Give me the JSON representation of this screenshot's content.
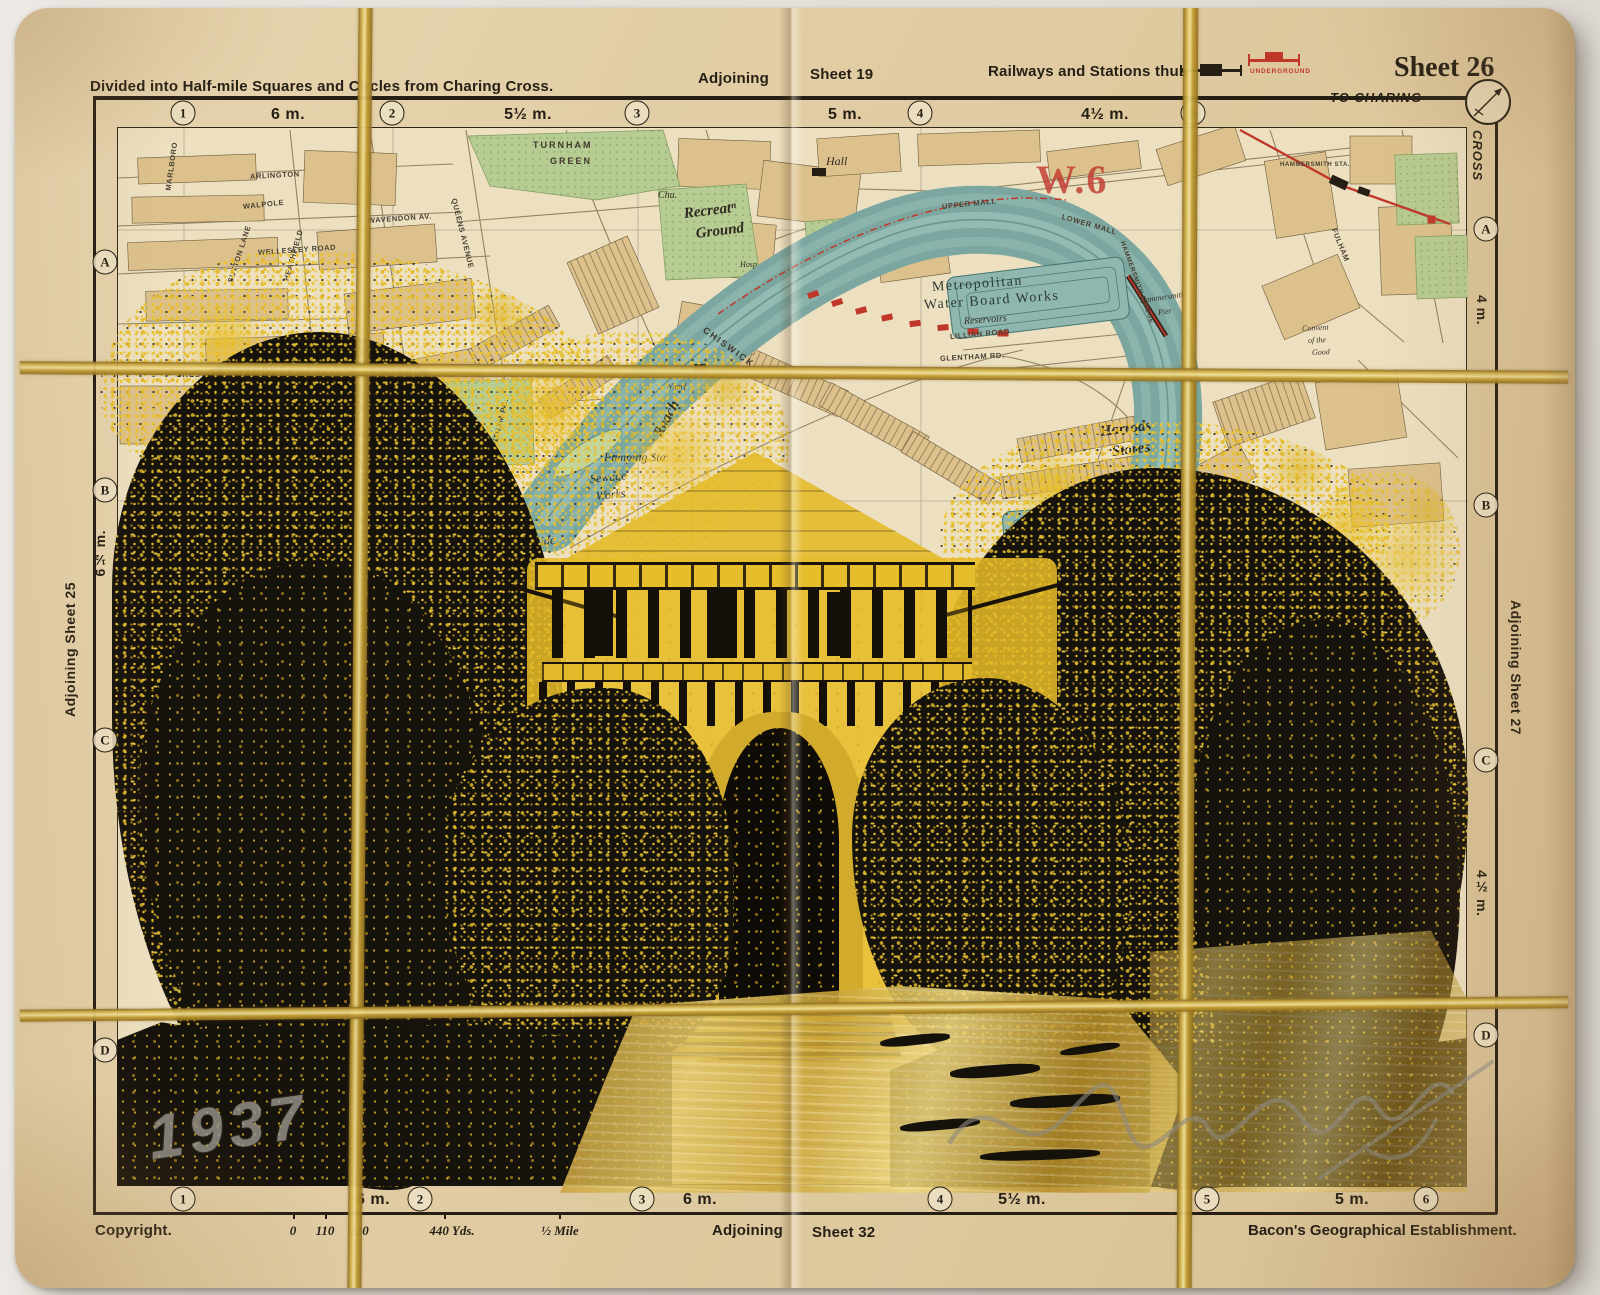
{
  "header": {
    "divided": "Divided into Half-mile Squares and Circles from Charing Cross.",
    "adjoining": "Adjoining",
    "sheet_19": "Sheet 19",
    "railways": "Railways and Stations thus",
    "underground": "UNDERGROUND",
    "sheet_26": "Sheet 26",
    "to_charing": "TO CHARING",
    "cross": "CROSS"
  },
  "scales": {
    "top_circles": [
      "1",
      "2",
      "3",
      "4",
      "5"
    ],
    "top_miles": [
      "6 m.",
      "5½ m.",
      "5 m.",
      "4½ m."
    ],
    "bottom_circles": [
      "1",
      "2",
      "3",
      "4",
      "5",
      "6"
    ],
    "bottom_miles": [
      "6 m.",
      "6 m.",
      "5½ m.",
      "5 m."
    ],
    "left_letters": [
      "A",
      "B",
      "C",
      "D"
    ],
    "right_letters": [
      "A",
      "B",
      "C",
      "D"
    ],
    "left_distance": "6½ m.",
    "right_distance_upper": "4 m.",
    "right_distance_lower": "4½ m."
  },
  "margins": {
    "left_adjoining": "Adjoining Sheet 25",
    "right_adjoining": "Adjoining Sheet 27"
  },
  "footer": {
    "copyright": "Copyright.",
    "scale_ticks": [
      "0",
      "110",
      "220",
      "440 Yds.",
      "½ Mile"
    ],
    "adjoining": "Adjoining",
    "sheet_32": "Sheet 32",
    "publisher": "Bacon's Geographical Establishment."
  },
  "map": {
    "labels": {
      "turnham": "TURNHAM",
      "green": "GREEN",
      "chu": "Chu.",
      "recreation": "Recreatⁿ",
      "ground": "Ground",
      "hall": "Hall",
      "arlington": "ARLINGTON",
      "walpole": "WALPOLE",
      "wellesley": "WELLESLEY ROAD",
      "grosvenor": "GROSVENOR",
      "barrowgate": "BARROWGATE ROAD",
      "wavendon": "WAVENDON AV.",
      "queens_avenue": "QUEENS AVENUE",
      "sutton_lane": "SUTTON LANE",
      "heathfield": "HEATHFIELD",
      "marlboro": "MARLBORO",
      "chiswick": "CHISWICK",
      "hosp": "Hosp",
      "wharf": "Wharf",
      "reach": "Reach",
      "riverside": "Riverside",
      "lands": "Lands",
      "grantham": "GRANTHAM RD.",
      "pumping_w": "Pumping Sta",
      "sewage": "Sewage",
      "works": "Works",
      "upper_mall": "UPPER MALL",
      "lower_mall": "LOWER MALL",
      "district": "W.6",
      "met1": "Metropolitan",
      "met2": "Water Board Works",
      "met3": "Reservoirs",
      "lillian": "LILLIAN ROAD",
      "glentham": "GLENTHAM RD.",
      "ham_bridge": "HAMMERSMITH BRIDGE",
      "ham_pier1": "Hammersmith",
      "ham_pier2": "Pier",
      "ham_sta": "HAMMERSMITH STA.",
      "convent1": "Convent",
      "convent2": "of the",
      "convent3": "Good",
      "fulham": "FULHAM",
      "harrods1": "Harrods",
      "harrods2": "Stores",
      "pumping_e": "Pumping Sta.",
      "castelnau": "CASTELNAU",
      "met4": "Metropolit"
    }
  },
  "annotations": {
    "date": "1937"
  },
  "colors": {
    "paper": "#e3cfa7",
    "map_bg": "#ece0c1",
    "river": "#7ba7a0",
    "park": "#b7cc92",
    "block": "#dcc18d",
    "print_yellow": "#e7bd2b",
    "print_black": "#161209",
    "gold": "#c9a43c",
    "red": "#bf382a"
  }
}
